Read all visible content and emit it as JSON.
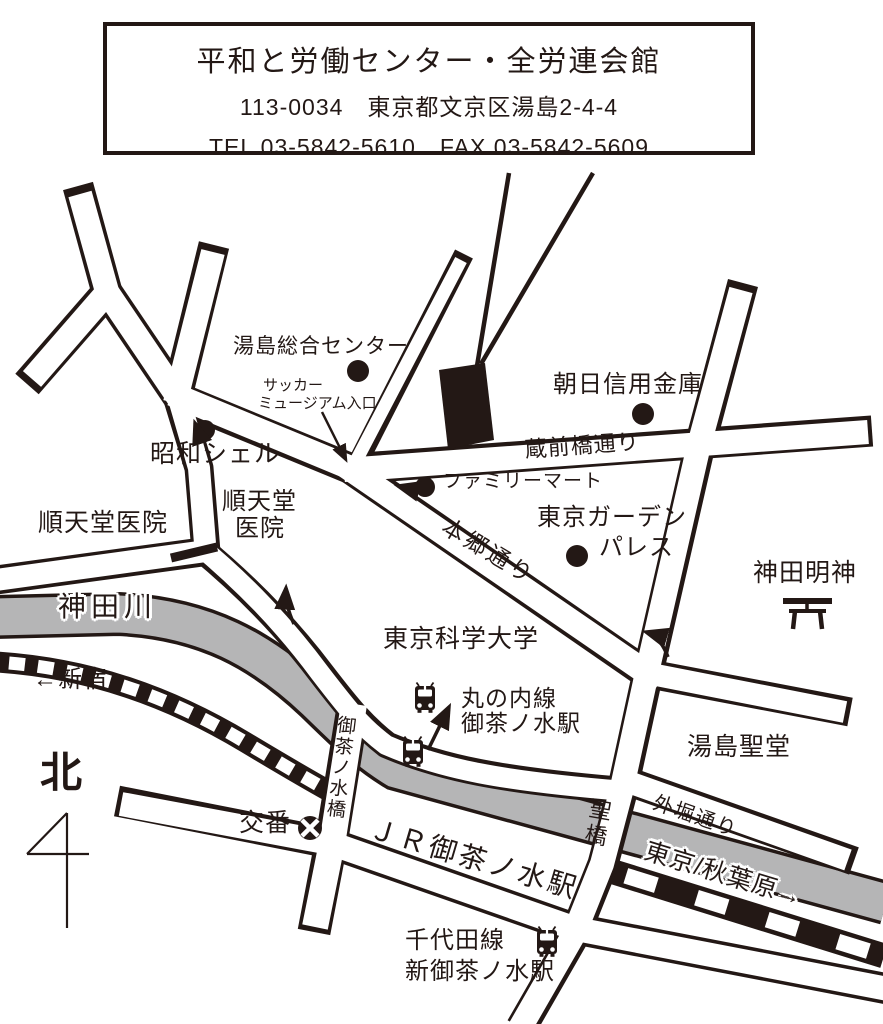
{
  "colors": {
    "ink": "#231815",
    "river_gray": "#b5b5b6",
    "background": "#ffffff"
  },
  "header": {
    "title": "平和と労働センター・全労連会館",
    "address": "113-0034　東京都文京区湯島2-4-4",
    "phone": "TEL 03-5842-5610　FAX 03-5842-5609"
  },
  "places": {
    "yushima_center": "湯島総合センター",
    "soccer_line1": "サッカー",
    "soccer_line2": "ミュージアム入口",
    "asahi_bank": "朝日信用金庫",
    "familymart": "ファミリーマート",
    "tokyo_garden_line1": "東京ガーデン",
    "tokyo_garden_line2": "パレス",
    "showa_shell": "昭和シェル",
    "juntendo_left": "順天堂医院",
    "juntendo_right_line1": "順天堂",
    "juntendo_right_line2": "医院",
    "kanda_myojin": "神田明神",
    "yushima_seido": "湯島聖堂",
    "tokyo_kagaku_univ": "東京科学大学",
    "koban": "交番"
  },
  "streets": {
    "kuramaebashi_dori": "蔵前橋通り",
    "hongo_dori": "本郷通り",
    "sotobori_dori": "外堀通り",
    "hijiribashi": "聖橋",
    "ochanomizubashi": "御茶ノ水橋",
    "kanda_river": "神田川",
    "to_shinjuku": "←新宿",
    "to_tokyo_akihabara": "東京/秋葉原→",
    "north": "北"
  },
  "transit": {
    "marunouchi_line1": "丸の内線",
    "marunouchi_line2": "御茶ノ水駅",
    "jr_station": "ＪＲ御茶ノ水駅",
    "chiyoda_line1": "千代田線",
    "chiyoda_line2": "新御茶ノ水駅"
  },
  "icons": {
    "train": "train-front-icon",
    "torii": "shrine-torii-icon",
    "koban": "police-box-circle-x-icon",
    "compass": "north-arrow-icon",
    "poi": "black-dot-marker",
    "destination": "black-building-block"
  }
}
